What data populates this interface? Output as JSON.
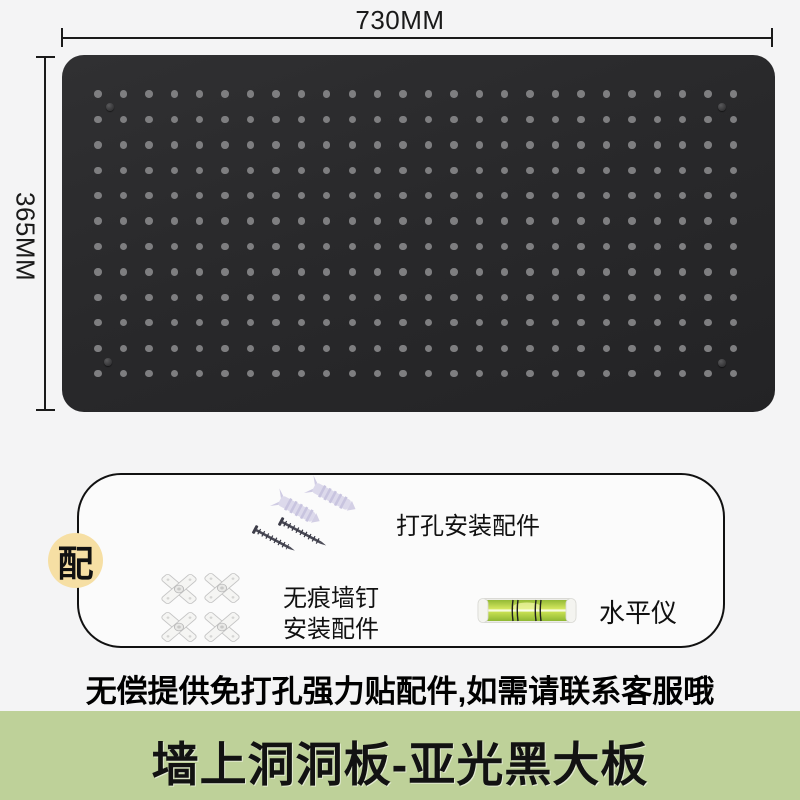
{
  "colors": {
    "page_bg": "#f4f4f5",
    "board": "#29292b",
    "hole": "#7e7e80",
    "box_bg": "#fbfbfb",
    "badge_bg": "#f6dfa4",
    "banner_bg": "#bed199"
  },
  "dimensions": {
    "width_label": "730MM",
    "height_label": "365MM"
  },
  "board": {
    "grid": {
      "cols": 26,
      "rows": 12,
      "start_x": 36,
      "start_y": 39,
      "spacing": 25.42,
      "hole_size": 7.4
    },
    "screws": [
      [
        48,
        52
      ],
      [
        660,
        52
      ],
      [
        46,
        307
      ],
      [
        660,
        308
      ]
    ],
    "screw_size": 8.5
  },
  "accessories": {
    "badge_label": "配",
    "drill_kit_label": "打孔安装配件",
    "nail_kit_label_lines": [
      "无痕墙钉",
      "安装配件"
    ],
    "level_label": "水平仪"
  },
  "caption": "无偿提供免打孔强力贴配件,如需请联系客服哦",
  "banner_title": "墙上洞洞板-亚光黑大板"
}
